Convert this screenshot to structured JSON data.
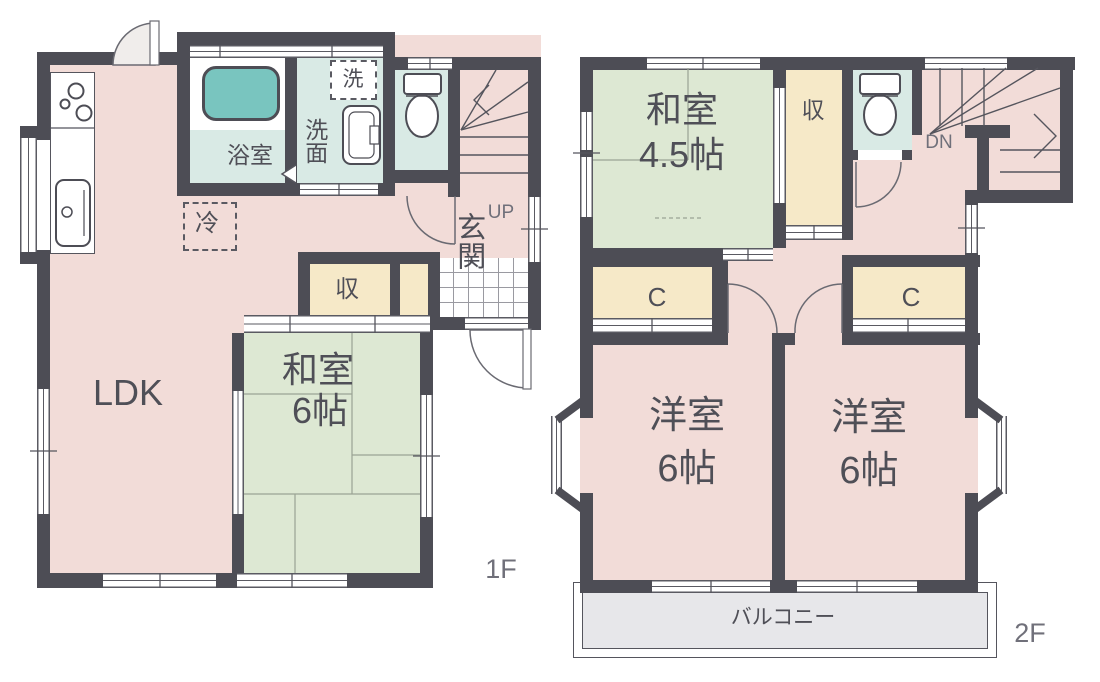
{
  "plan": {
    "f1": {
      "floor_label": "1F",
      "ldk_label": "LDK",
      "washitsu_name": "和室",
      "washitsu_size": "6帖",
      "bathroom_label": "浴室",
      "washroom_label": "洗面",
      "laundry_label": "洗",
      "refrigerator_label": "冷",
      "storage_label": "収",
      "entrance_label": "玄関",
      "stairs_label": "UP"
    },
    "f2": {
      "floor_label": "2F",
      "washitsu_name": "和室",
      "washitsu_size": "4.5帖",
      "storage_label": "収",
      "closet_left_label": "C",
      "closet_right_label": "C",
      "stairs_label": "DN",
      "bedroom_left_name": "洋室",
      "bedroom_left_size": "6帖",
      "bedroom_right_name": "洋室",
      "bedroom_right_size": "6帖",
      "balcony_label": "バルコニー"
    },
    "colors": {
      "wall": "#4d4d55",
      "floor_pink": "#f2dcd8",
      "tatami_green": "#dde8d3",
      "closet_yellow": "#f6e9c8",
      "wet_area_teal": "#d9eae5",
      "bathtub_teal": "#79c5bf",
      "balcony_gray": "#e7e7ea",
      "text_dark": "#4f4f57",
      "text_gray": "#70707a"
    }
  }
}
